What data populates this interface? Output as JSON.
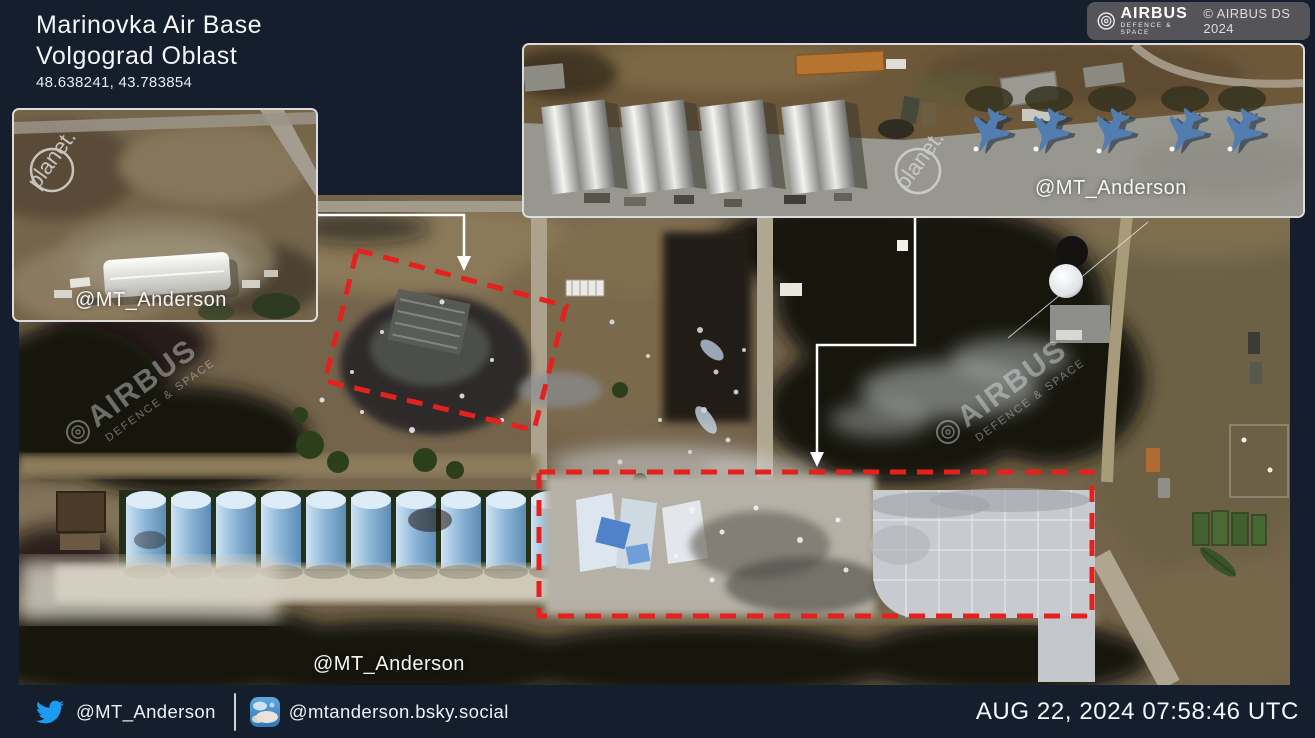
{
  "header": {
    "title_line1": "Marinovka Air Base",
    "title_line2": "Volgograd Oblast",
    "coordinates": "48.638241, 43.783854"
  },
  "credit_badge": {
    "brand": "AIRBUS",
    "division": "DEFENCE & SPACE",
    "copyright": "© AIRBUS DS 2024"
  },
  "insets": {
    "hangar": {
      "label": "@MT_Anderson",
      "watermark": "planet."
    },
    "jets": {
      "label": "@MT_Anderson",
      "watermark": "planet."
    }
  },
  "main_image": {
    "label": "@MT_Anderson",
    "watermark_brand": "AIRBUS",
    "watermark_division": "DEFENCE & SPACE",
    "annotation_left": "red dashed polygon around destroyed depot",
    "annotation_bottom": "red dashed rectangle around destroyed warehouses and apron"
  },
  "footer": {
    "twitter_handle": "@MT_Anderson",
    "bluesky_handle": "@mtanderson.bsky.social",
    "timestamp": "AUG 22, 2024 07:58:46 UTC"
  },
  "colors": {
    "background_navy": "#141e2c",
    "annotation_red": "#e4211e",
    "callout_white": "#ffffff",
    "twitter_blue": "#1d9bf0",
    "silo_blue": "#8fb8d9"
  }
}
